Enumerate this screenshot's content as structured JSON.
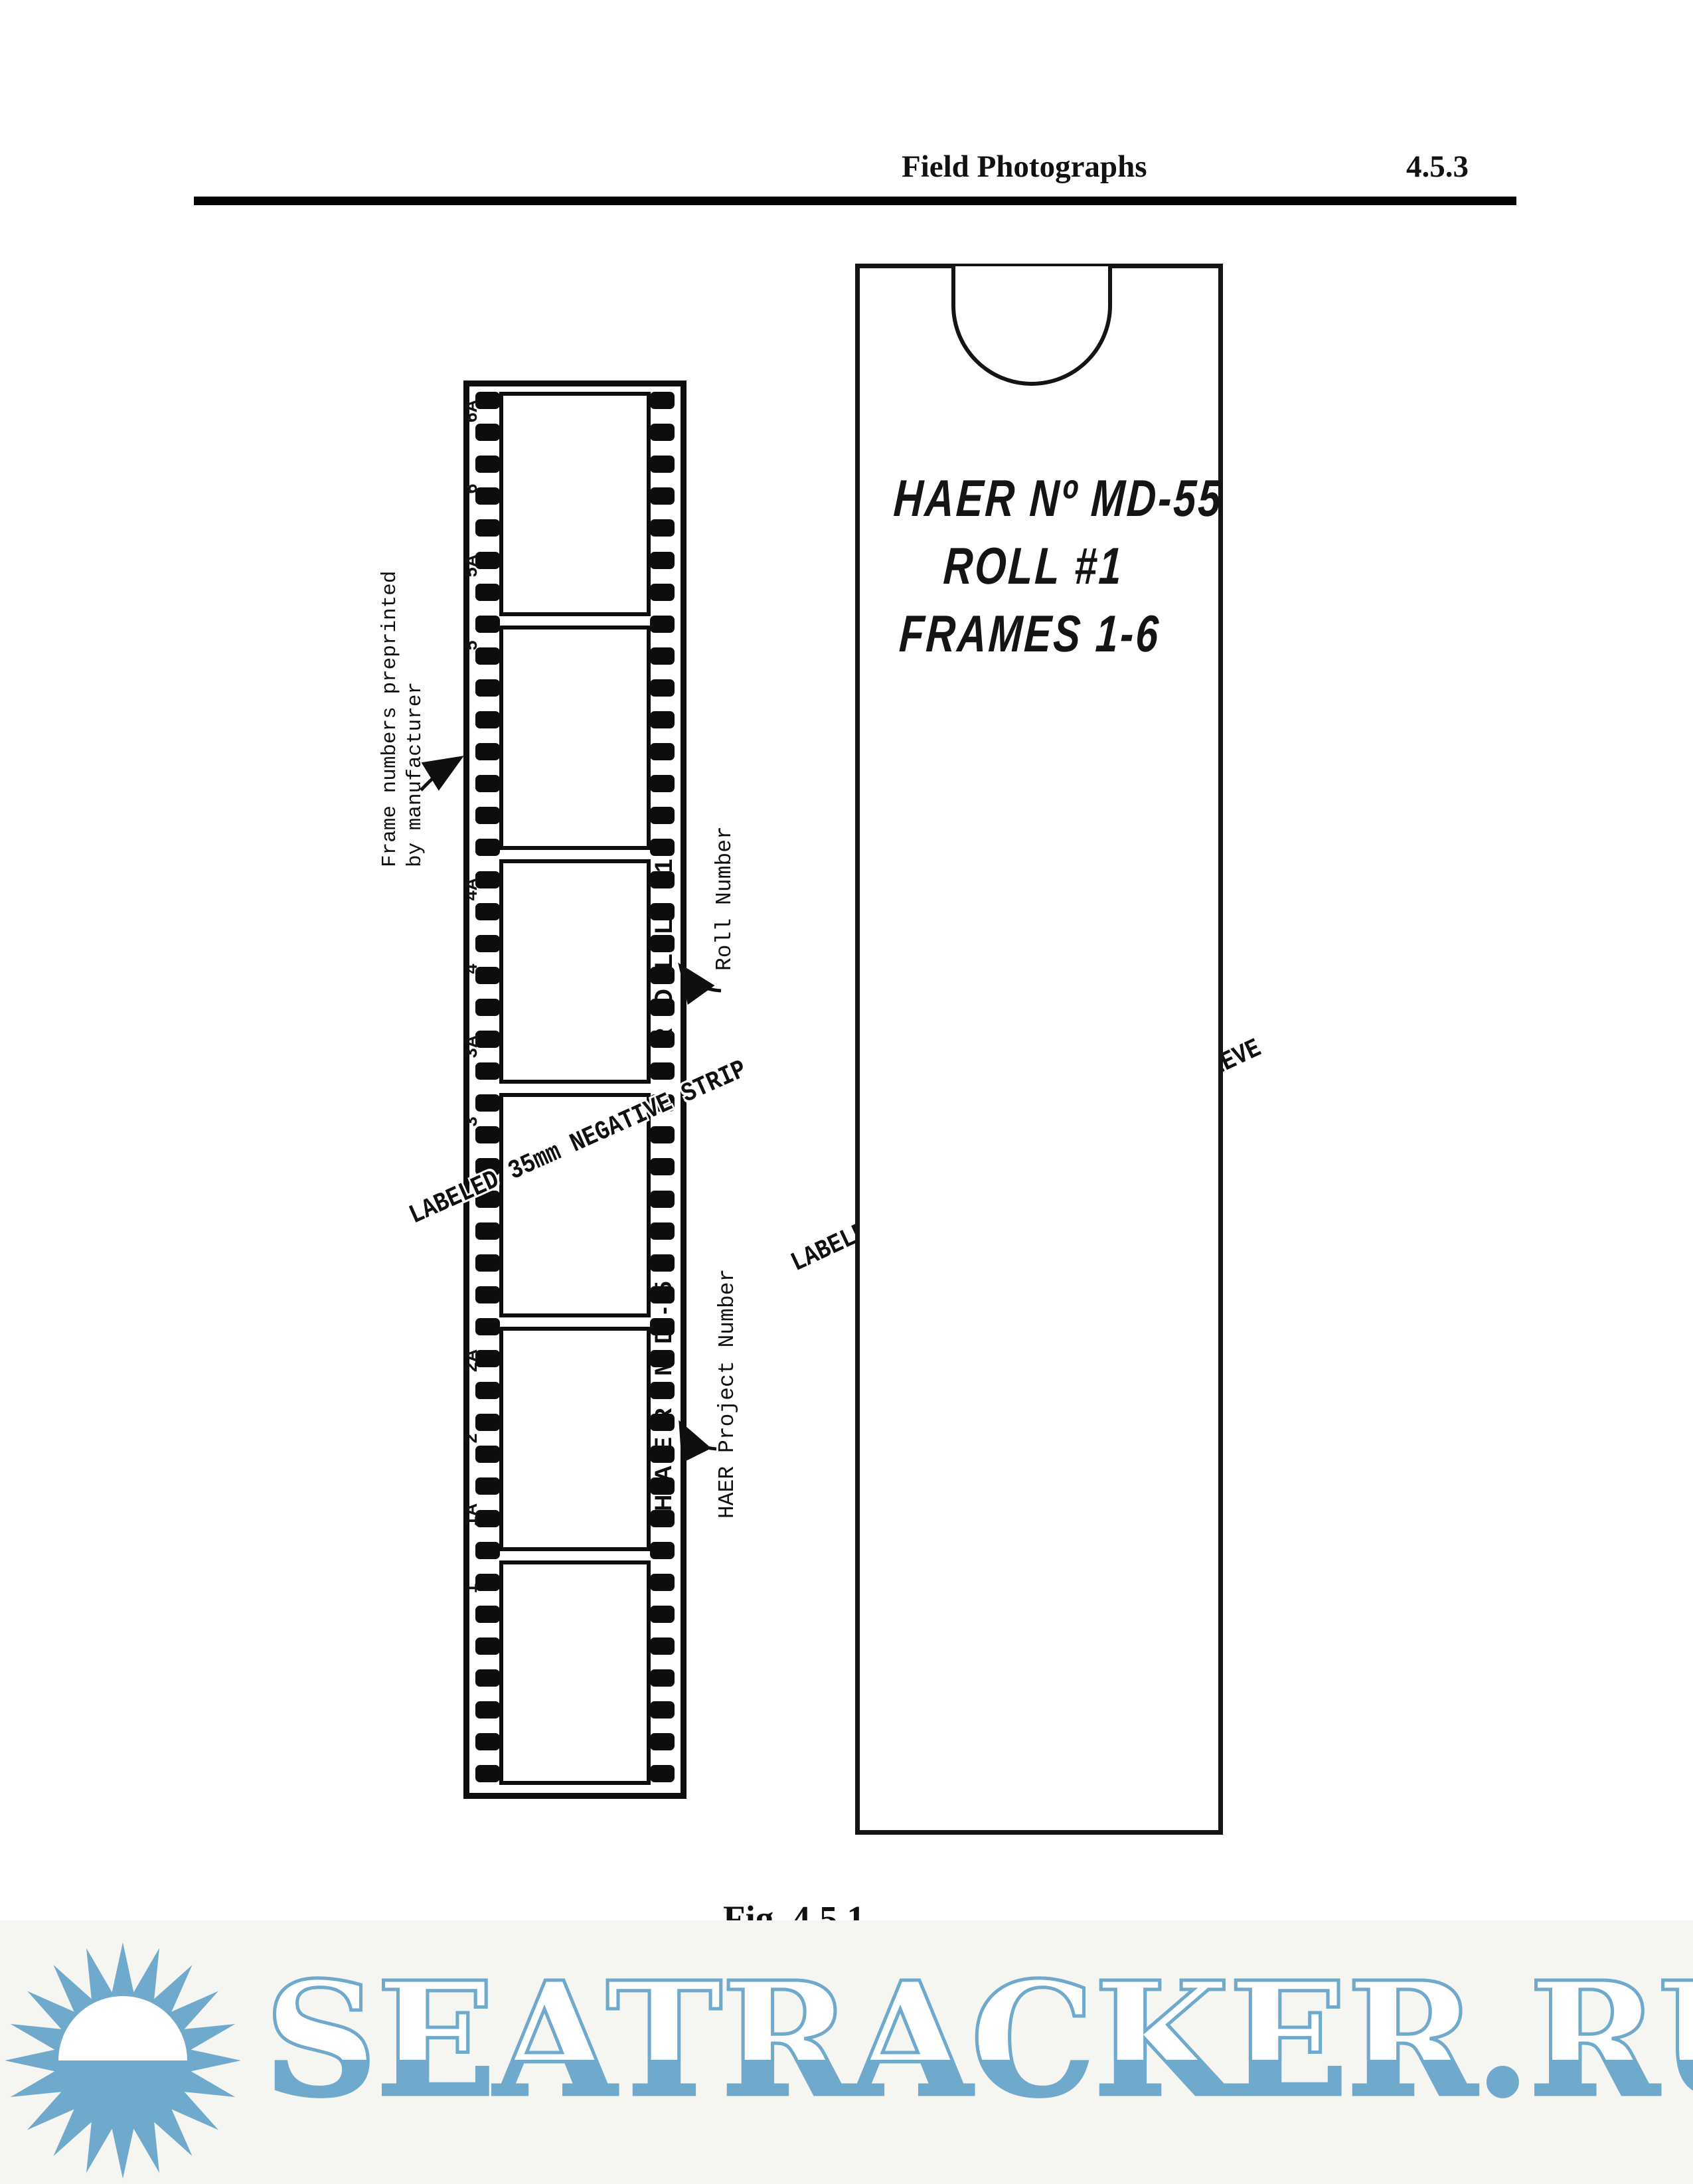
{
  "header": {
    "title": "Field Photographs",
    "section": "4.5.3"
  },
  "film_strip": {
    "frame_numbers": [
      "6A",
      "6",
      "5A",
      "5",
      "4A",
      "4",
      "3A",
      "3",
      "2A",
      "2",
      "1A",
      "1"
    ],
    "edge_label_roll": "ROLL 1",
    "edge_label_project": "HAER MD-55",
    "diagonal_label": "LABELED 35mm NEGATIVE STRIP",
    "annotations": {
      "frame_numbers_note_line1": "Frame numbers preprinted",
      "frame_numbers_note_line2": "by manufacturer",
      "roll_number_note": "Roll Number",
      "project_number_note": "HAER Project Number"
    }
  },
  "sleeve": {
    "diagonal_label": "LABELED ARCHIVAL PAPER NEGATIVE SLEEVE",
    "handwriting": [
      "HAER Nº MD-55",
      "ROLL #1",
      "FRAMES 1-6"
    ]
  },
  "caption": {
    "fig": "Fig. 4.5.1",
    "title": "Field Film Labeling"
  },
  "watermark": {
    "text": "SEATRACKER.RU",
    "color": "#6fa9cc",
    "icon": "sun-icon"
  }
}
